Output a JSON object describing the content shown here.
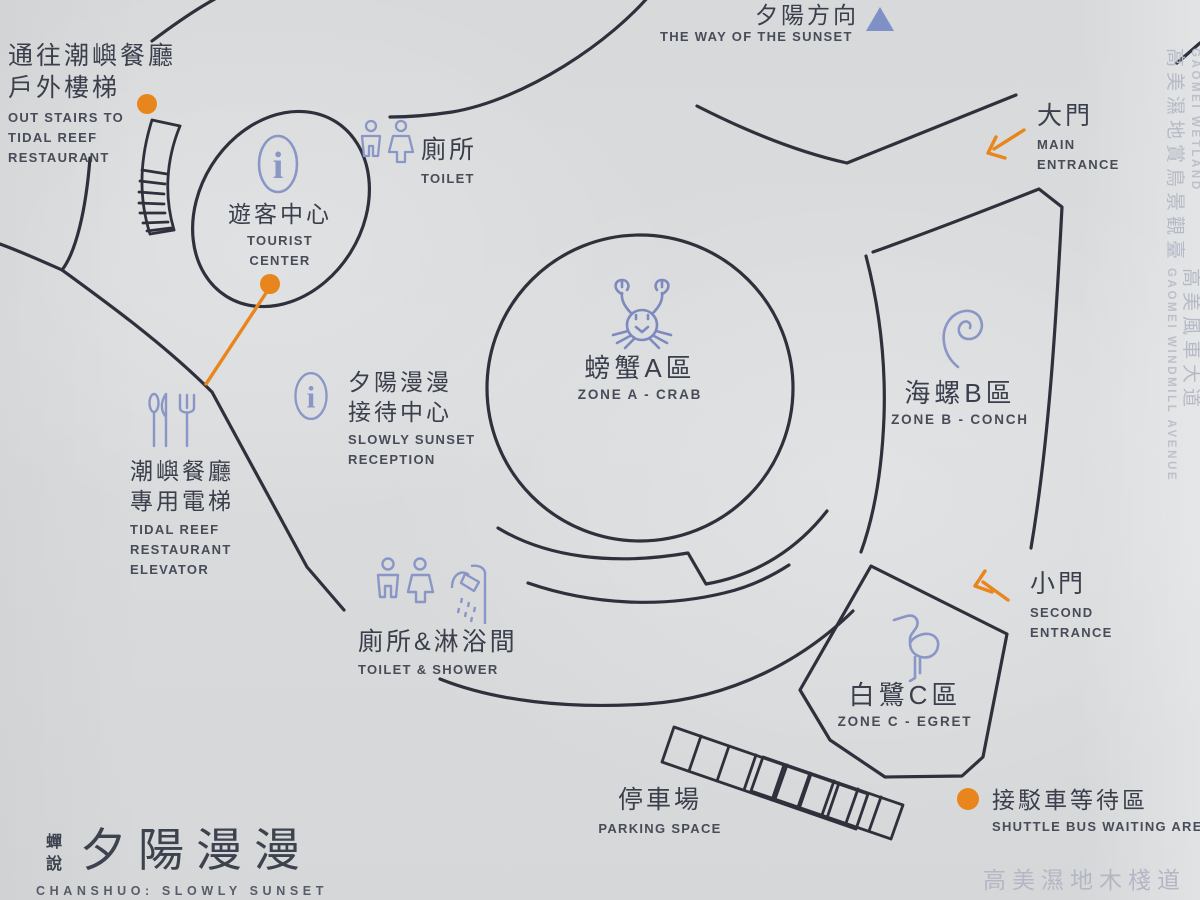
{
  "colors": {
    "paper": "#d8dadc",
    "map_ink": "#2e313b",
    "text_zh": "#3a3f4b",
    "text_en": "#474c58",
    "icon_blue": "#8a96c5",
    "crab_blue": "#7e8abf",
    "accent_orange": "#e8851c",
    "edge_gray": "#b6bac6",
    "triangle_blue": "#7e90c5"
  },
  "icons": {
    "info_glyph": "i"
  },
  "compass": {
    "zh": "夕陽方向",
    "en": "THE WAY OF THE SUNSET"
  },
  "pois": {
    "stairs": {
      "zh1": "通往潮嶼餐廳",
      "zh2": "戶外樓梯",
      "en1": "OUT STAIRS TO",
      "en2": "TIDAL REEF",
      "en3": "RESTAURANT"
    },
    "toilet": {
      "zh": "廁所",
      "en": "TOILET"
    },
    "tourist_center": {
      "zh": "遊客中心",
      "en1": "TOURIST",
      "en2": "CENTER"
    },
    "reception": {
      "zh1": "夕陽漫漫",
      "zh2": "接待中心",
      "en1": "SLOWLY SUNSET",
      "en2": "RECEPTION"
    },
    "elevator": {
      "zh1": "潮嶼餐廳",
      "zh2": "專用電梯",
      "en1": "TIDAL REEF",
      "en2": "RESTAURANT",
      "en3": "ELEVATOR"
    },
    "toilet_shower": {
      "zh": "廁所&淋浴間",
      "en": "TOILET & SHOWER"
    },
    "zone_a": {
      "zh": "螃蟹A區",
      "en": "ZONE A - CRAB"
    },
    "zone_b": {
      "zh": "海螺B區",
      "en": "ZONE B - CONCH"
    },
    "zone_c": {
      "zh": "白鷺C區",
      "en": "ZONE C - EGRET"
    },
    "main_entrance": {
      "zh": "大門",
      "en1": "MAIN",
      "en2": "ENTRANCE"
    },
    "second_entrance": {
      "zh": "小門",
      "en1": "SECOND",
      "en2": "ENTRANCE"
    },
    "parking": {
      "zh": "停車場",
      "en": "PARKING SPACE"
    },
    "shuttle": {
      "zh": "接駁車等待區",
      "en": "SHUTTLE BUS WAITING AREA"
    }
  },
  "edge_labels": {
    "wetland": {
      "zh": "高美濕地賞鳥景觀臺",
      "en": "GAOMEI WETLAND"
    },
    "windmill": {
      "zh": "高美風車大道",
      "en": "GAOMEI WINDMILL AVENUE"
    },
    "boardwalk": {
      "zh": "高美濕地木棧道"
    }
  },
  "brand": {
    "zh_small": "蟬說",
    "zh_large": "夕陽漫漫",
    "en": "CHANSHUO: SLOWLY SUNSET"
  }
}
